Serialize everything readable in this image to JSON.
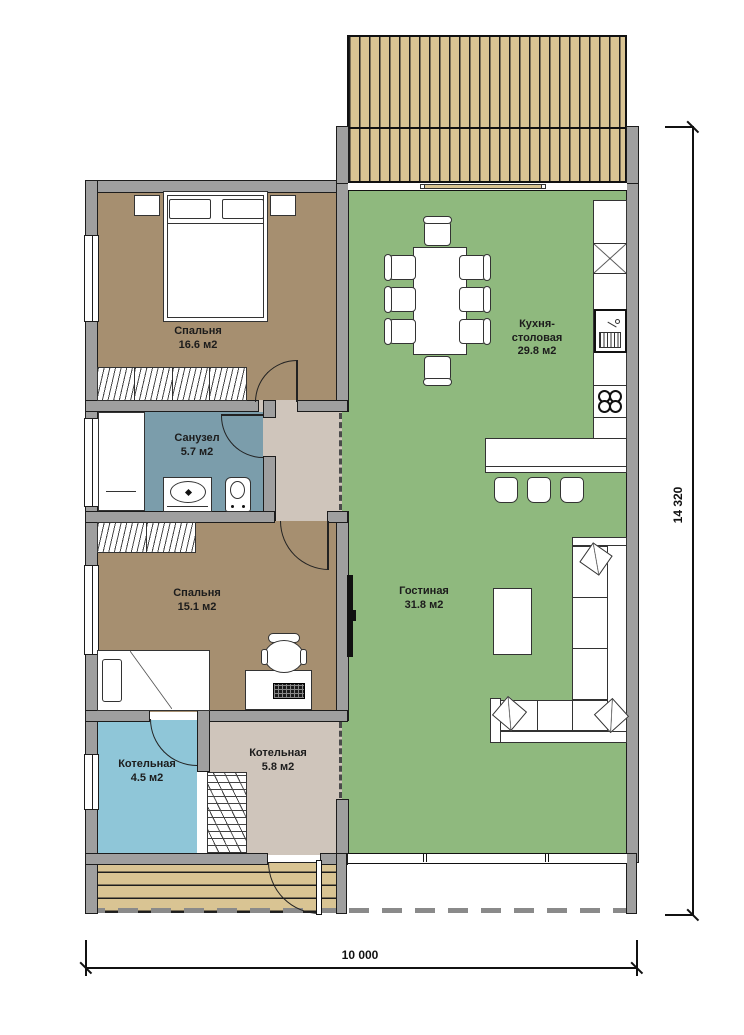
{
  "labels": {
    "bedroom1": {
      "name": "Спальня",
      "area": "16.6 м2"
    },
    "bathroom": {
      "name": "Санузел",
      "area": "5.7 м2"
    },
    "bedroom2": {
      "name": "Спальня",
      "area": "15.1 м2"
    },
    "boiler_small": {
      "name": "Котельная",
      "area": "4.5 м2"
    },
    "boiler_large": {
      "name": "Котельная",
      "area": "5.8 м2"
    },
    "kitchen": {
      "line1": "Кухня-",
      "line2": "столовая",
      "area": "29.8 м2"
    },
    "living": {
      "name": "Гостиная",
      "area": "31.8 м2"
    }
  },
  "dimensions": {
    "vertical": "14 320",
    "horizontal": "10 000"
  },
  "colors": {
    "bedroom": "#a68f70",
    "bathroom": "#7b9dab",
    "boiler": "#8fc6d8",
    "hall": "#cfc5bb",
    "living": "#8fb97e",
    "deck": "#d9c493",
    "wall": "#9f9f9f"
  }
}
